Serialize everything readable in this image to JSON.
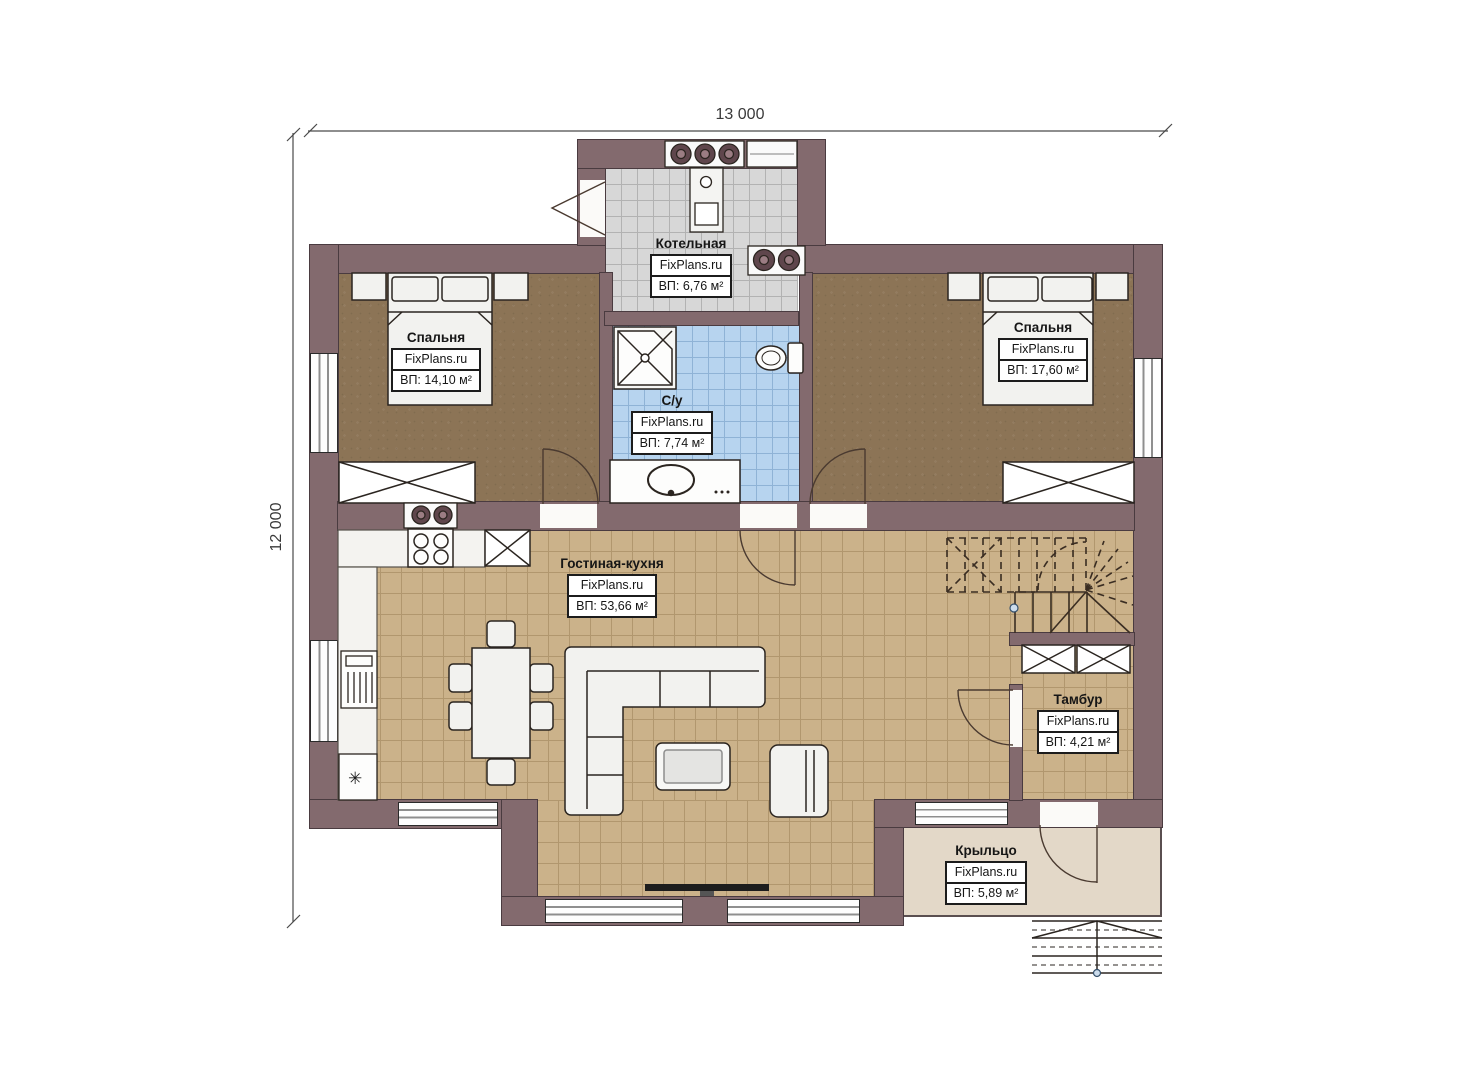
{
  "dimensions": {
    "top": "13 000",
    "left": "12 000"
  },
  "brand": "FixPlans.ru",
  "rooms": {
    "boiler": {
      "name": "Котельная",
      "area": "ВП: 6,76 м²"
    },
    "bedroom_left": {
      "name": "Спальня",
      "area": "ВП: 14,10 м²"
    },
    "bedroom_right": {
      "name": "Спальня",
      "area": "ВП: 17,60 м²"
    },
    "bathroom": {
      "name": "С/у",
      "area": "ВП: 7,74 м²"
    },
    "living": {
      "name": "Гостиная-кухня",
      "area": "ВП: 53,66 м²"
    },
    "tambour": {
      "name": "Тамбур",
      "area": "ВП: 4,21 м²"
    },
    "porch": {
      "name": "Крыльцо",
      "area": "ВП: 5,89 м²"
    }
  },
  "symbols": {
    "freezer": "✳"
  },
  "colors": {
    "wall": "#836a6e",
    "bedroom_floor": "#8c7456",
    "living_floor": "#cbb28a",
    "bathroom_floor": "#b7d4ef",
    "boiler_floor": "#d7d7d7",
    "porch_floor": "#e3d8c8",
    "equipment": "#5f464c"
  }
}
